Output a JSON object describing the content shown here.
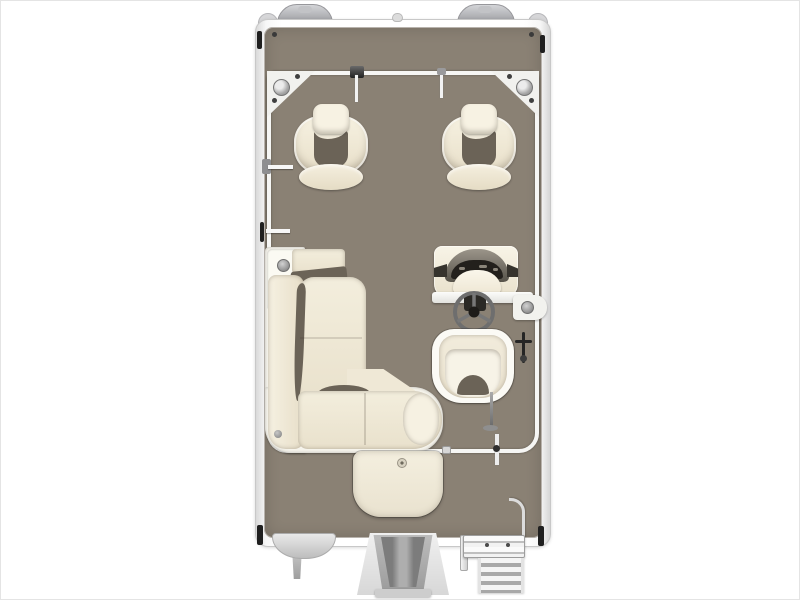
{
  "title": "Pontoon Boat Deck Plan (Overhead View)",
  "colors": {
    "background": "#ffffff",
    "deck": "#8a8174",
    "shadow_crease": "#6b6357",
    "upholstery": "#efe8d6",
    "upholstery_light": "#f7f2e4",
    "base_white": "#f6f4ec",
    "rail_white": "#f6f6f4",
    "hardware_dark": "#252525",
    "hardware_gray": "#8f8f8f",
    "motor_gray": "#9c9c9c",
    "console_dark": "#57534a"
  },
  "labels": {
    "canvas": "Pontoon boat floorplan, top-down view",
    "hull": "Pontoon boat hull",
    "deck": "Deck floor",
    "fence": "Perimeter fence rail",
    "port_bow_cap": "Port pontoon bow cap",
    "stbd_bow_cap": "Starboard pontoon bow cap",
    "port_corner_cap": "Port bow corner cap",
    "stbd_corner_cap": "Starboard bow corner cap",
    "port_plate": "Port bow corner plate with pedestal seat base",
    "stbd_plate": "Starboard bow corner plate with pedestal seat base",
    "bow_gate_latch": "Bow gate latch",
    "bow_gate_post": "Bow gate post",
    "bow_gate_hinge": "Bow gate hinge",
    "nav_light": "Bow navigation light",
    "port_chair": "Port pedestal fishing chair",
    "stbd_chair": "Starboard pedestal fishing chair",
    "port_gate_hinge": "Port side gate hinge",
    "port_gate_latch": "Port side gate latch",
    "lounge_base": "L-shaped lounge base",
    "lounge_armrest": "Lounge armrest console",
    "cup_holder": "Cup holder",
    "lounge_cushion": "Lounge cushion",
    "helm_console": "Helm console",
    "helm_windscreen": "Helm windscreen and dashboard",
    "steering_wheel": "Steering wheel",
    "helm_cup_holder": "Helm side cup holder",
    "helm_seat": "Captain's helm seat",
    "stbd_gate_latch": "Starboard boarding gate latch",
    "ski_pylon": "Ski tow pylon",
    "stern_gate_latch": "Stern gate latch",
    "stern_hatch": "Stern walk-through step pad",
    "outboard_motor": "Outboard motor",
    "port_stern_cap": "Port pontoon stern cap",
    "port_skeg": "Port pontoon skeg",
    "ladder": "Stern boarding ladder",
    "grab_handle": "Ladder grab handle",
    "mooring_cleat": "Mooring cleat",
    "deck_screw": "Deck screw"
  }
}
